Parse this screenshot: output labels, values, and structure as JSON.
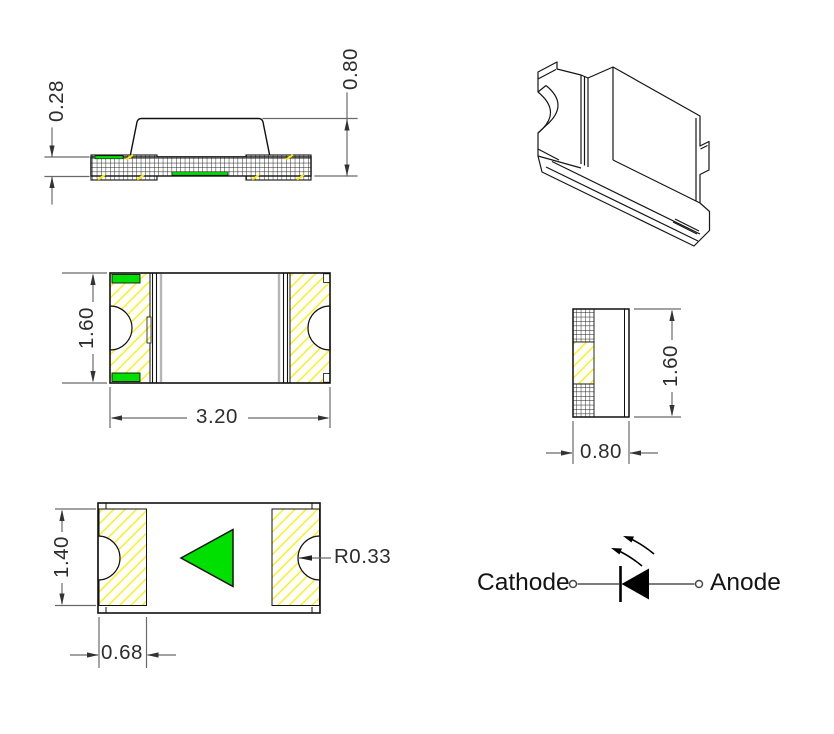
{
  "drawing": {
    "views": {
      "side": {
        "substrate_height": "0.28",
        "total_height": "0.80"
      },
      "top": {
        "height": "1.60",
        "width": "3.20"
      },
      "bottom": {
        "pad_height": "1.40",
        "pad_width": "0.68",
        "notch_radius": "R0.33"
      },
      "end": {
        "width": "0.80",
        "height": "1.60"
      },
      "schematic": {
        "cathode": "Cathode",
        "anode": "Anode"
      }
    },
    "colors": {
      "pad_hatch_yellow": "#ffee00",
      "polarity_green": "#00e000",
      "outline": "#111111",
      "dimension_gray": "#6a6a6a"
    }
  }
}
